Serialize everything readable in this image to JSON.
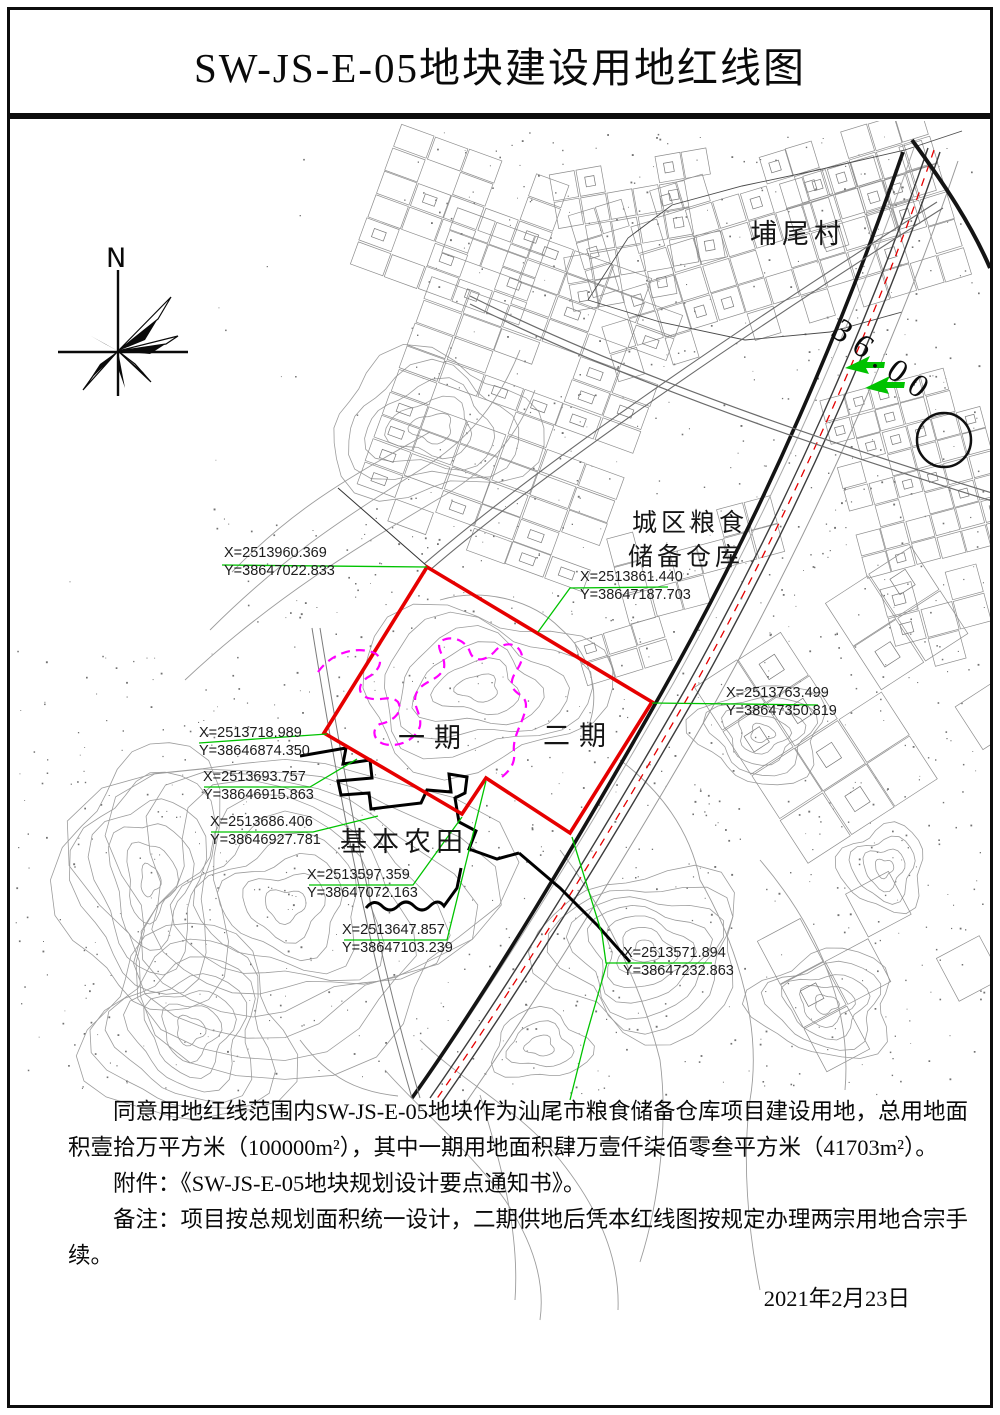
{
  "title": "SW-JS-E-05地块建设用地红线图",
  "map": {
    "compass_label": "N",
    "labels": {
      "village": "埔尾村",
      "road_width": "36.00",
      "warehouse_line1": "城区粮食",
      "warehouse_line2": "储备仓库",
      "phase1": "一期",
      "phase2": "二期",
      "farmland": "基本农田"
    },
    "coordinates": [
      {
        "x": "X=2513960.369",
        "y": "Y=38647022.833"
      },
      {
        "x": "X=2513861.440",
        "y": "Y=38647187.703"
      },
      {
        "x": "X=2513763.499",
        "y": "Y=38647350.819"
      },
      {
        "x": "X=2513718.989",
        "y": "Y=38646874.350"
      },
      {
        "x": "X=2513693.757",
        "y": "Y=38646915.863"
      },
      {
        "x": "X=2513686.406",
        "y": "Y=38646927.781"
      },
      {
        "x": "X=2513597.359",
        "y": "Y=38647072.163"
      },
      {
        "x": "X=2513647.857",
        "y": "Y=38647103.239"
      },
      {
        "x": "X=2513571.894",
        "y": "Y=38647232.863"
      }
    ],
    "colors": {
      "red_line": "#e60000",
      "green_leader": "#00c300",
      "magenta_divider": "#ff00ff",
      "farmland_line": "#000000"
    }
  },
  "notes": {
    "paragraph1": "同意用地红线范围内SW-JS-E-05地块作为汕尾市粮食储备仓库项目建设用地，总用地面积壹拾万平方米（100000m²），其中一期用地面积肆万壹仟柒佰零叁平方米（41703m²）。",
    "attachment": "附件：《SW-JS-E-05地块规划设计要点通知书》。",
    "remark": "备注：项目按总规划面积统一设计，二期供地后凭本红线图按规定办理两宗用地合宗手续。",
    "date": "2021年2月23日"
  }
}
